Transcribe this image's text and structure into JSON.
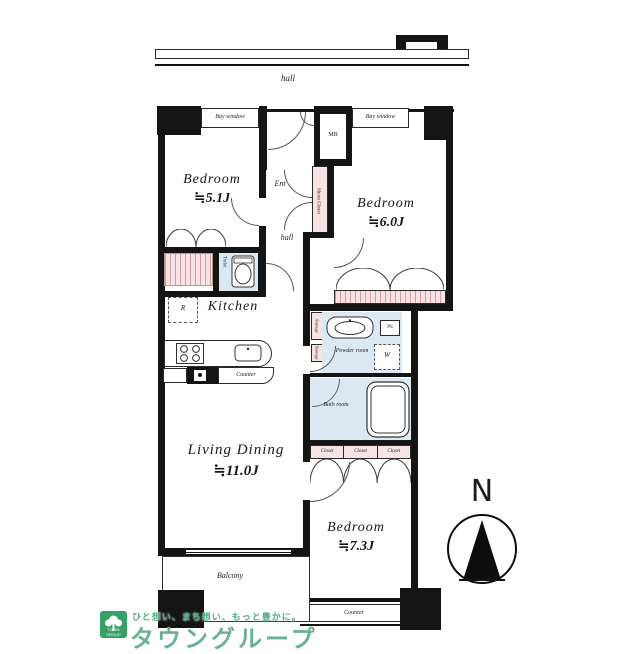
{
  "colors": {
    "wall": "#141414",
    "closet_fill": "#f7e3e3",
    "wet_area_fill": "#dce9f2",
    "logo_green": "#36a065",
    "watermark_green": "#3f9e72"
  },
  "corridor": {
    "hall": "hall"
  },
  "unit": {
    "bay_window": "Bay window",
    "mb": "MB",
    "entrance": "Ent",
    "shoes_closet": "Shoes Closet",
    "hall": "hall",
    "toilet": "Toilet",
    "kitchen": "Kitchen",
    "refrigerator": "R",
    "counter": "Counter",
    "storage": "Storage",
    "powder_room": "Powder room",
    "pipe_space": "PS",
    "washer": "W",
    "bath_room": "Bath room",
    "closet": "Closet",
    "balcony": "Balcony",
    "rooms": {
      "bedroom_small": {
        "name": "Bedroom",
        "area": "≒5.1J"
      },
      "bedroom_mid": {
        "name": "Bedroom",
        "area": "≒6.0J"
      },
      "bedroom_large": {
        "name": "Bedroom",
        "area": "≒7.3J"
      },
      "living_dining": {
        "name": "Living Dining",
        "area": "≒11.0J"
      }
    }
  },
  "compass": {
    "north": "N"
  },
  "branding": {
    "logo_text": "TOWN GROUP",
    "tagline": "ひと想い、まち想い、もっと豊かに。",
    "company": "タウングループ"
  }
}
